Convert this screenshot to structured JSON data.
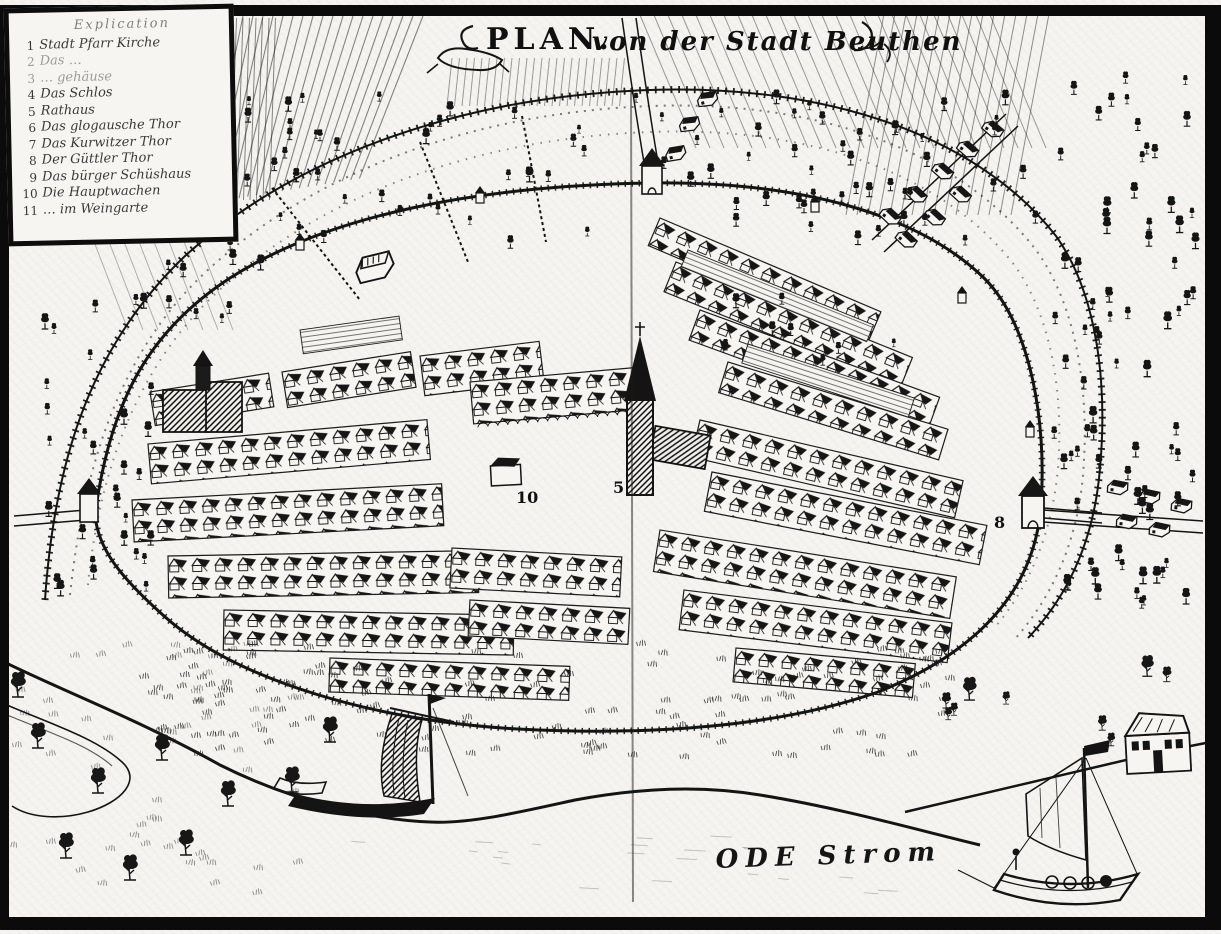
{
  "style": {
    "ink": "#161616",
    "paper": "#f5f4f0"
  },
  "artwork": {
    "title_word": "PLAN.",
    "title_rest": "von der Stadt Beuthen",
    "river_label": "ODE Strom",
    "map_numbers": [
      {
        "value": "10",
        "refers_to": "Die Hauptwachen"
      },
      {
        "value": "5",
        "refers_to": "Rathaus"
      },
      {
        "value": "8",
        "refers_to": "Thor"
      }
    ]
  },
  "legend": {
    "heading": "Explication",
    "items": [
      {
        "num": "1",
        "label": "Stadt Pfarr Kirche"
      },
      {
        "num": "2",
        "label": "Das …"
      },
      {
        "num": "3",
        "label": "… gehäuse"
      },
      {
        "num": "4",
        "label": "Das Schlos"
      },
      {
        "num": "5",
        "label": "Rathaus"
      },
      {
        "num": "6",
        "label": "Das glogausche Thor"
      },
      {
        "num": "7",
        "label": "Das Kurwitzer Thor"
      },
      {
        "num": "8",
        "label": "Der Güttler Thor"
      },
      {
        "num": "9",
        "label": "Das bürger Schüshaus"
      },
      {
        "num": "10",
        "label": "Die Hauptwachen"
      },
      {
        "num": "11",
        "label": "… im Weingarte"
      }
    ]
  }
}
